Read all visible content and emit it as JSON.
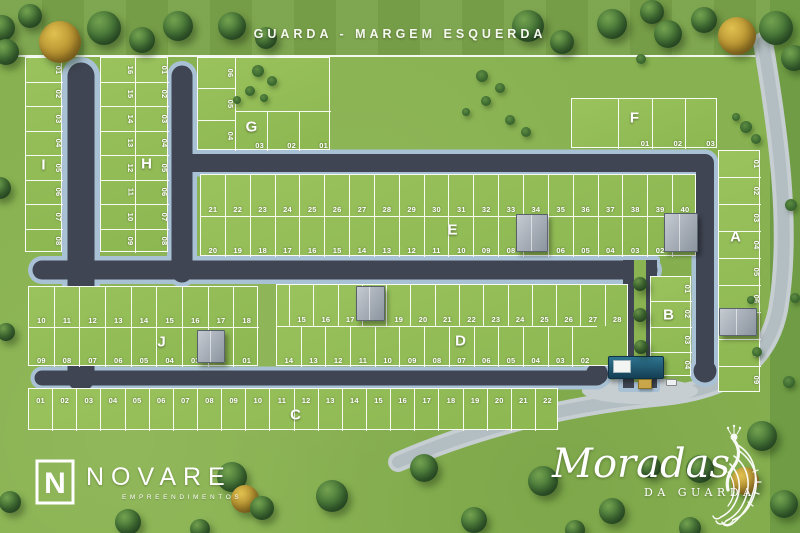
{
  "title": "GUARDA - MARGEM ESQUERDA",
  "branding": {
    "novare": {
      "icon_letter": "N",
      "name": "NOVARE",
      "subtitle": "EMPREENDIMENTOS"
    },
    "project": {
      "name": "Moradas",
      "subtitle": "DA GUARDA"
    }
  },
  "colors": {
    "grass": "#88b251",
    "block_grass": "#93bd58",
    "asphalt": "#3f4553",
    "sidewalk": "#a9c1d4",
    "exterior_road": "#c6ced1",
    "line_white": "#ffffff",
    "gate_roof": "#1d5570"
  },
  "blocks": [
    {
      "id": "A",
      "label": "A",
      "rows": [
        {
          "lots": [
            "01",
            "02",
            "03",
            "04",
            "05",
            "06",
            null,
            "08",
            "09"
          ]
        }
      ]
    },
    {
      "id": "B",
      "label": "B",
      "rows": [
        {
          "lots": [
            "01",
            "02",
            "03",
            "04"
          ]
        }
      ]
    },
    {
      "id": "C",
      "label": "C",
      "rows": [
        {
          "lots": [
            "01",
            "02",
            "03",
            "04",
            "05",
            "06",
            "07",
            "08",
            "09",
            "10",
            "11",
            "12",
            "13",
            "14",
            "15",
            "16",
            "17",
            "18",
            "19",
            "20",
            "21",
            "22"
          ]
        }
      ]
    },
    {
      "id": "D",
      "label": "D",
      "rows": [
        {
          "lots": [
            "15",
            "16",
            "17",
            null,
            "19",
            "20",
            "21",
            "22",
            "23",
            "24",
            "25",
            "26",
            "27",
            "28"
          ]
        },
        {
          "lots": [
            "14",
            "13",
            "12",
            "11",
            "10",
            "09",
            "08",
            "07",
            "06",
            "05",
            "04",
            "03",
            "02"
          ]
        }
      ]
    },
    {
      "id": "E",
      "label": "E",
      "rows": [
        {
          "lots": [
            "21",
            "22",
            "23",
            "24",
            "25",
            "26",
            "27",
            "28",
            "29",
            "30",
            "31",
            "32",
            "33",
            "34",
            "35",
            "36",
            "37",
            "38",
            "39",
            "40"
          ]
        },
        {
          "lots": [
            "20",
            "19",
            "18",
            "17",
            "16",
            "15",
            "14",
            "13",
            "12",
            "11",
            "10",
            "09",
            "08",
            null,
            "06",
            "05",
            "04",
            "03",
            "02",
            null
          ]
        }
      ]
    },
    {
      "id": "F",
      "label": "F",
      "rows": [
        {
          "lots": [
            null,
            "01",
            "02",
            "03"
          ]
        }
      ]
    },
    {
      "id": "G",
      "label": "G",
      "rows": [
        {
          "lots": [
            "06",
            "05",
            "04"
          ]
        },
        {
          "lots": [
            "03",
            "02",
            "01"
          ]
        }
      ]
    },
    {
      "id": "H",
      "label": "H",
      "rows": [
        {
          "lots": [
            "16",
            "15",
            "14",
            "13",
            "12",
            "11",
            "10",
            "09"
          ]
        },
        {
          "lots": [
            "01",
            "02",
            "03",
            "04",
            "05",
            "06",
            "07",
            "08"
          ]
        }
      ]
    },
    {
      "id": "I",
      "label": "I",
      "rows": [
        {
          "lots": [
            "01",
            "02",
            "03",
            "04",
            "05",
            "06",
            "07",
            "08"
          ]
        }
      ]
    },
    {
      "id": "J",
      "label": "J",
      "rows": [
        {
          "lots": [
            "10",
            "11",
            "12",
            "13",
            "14",
            "15",
            "16",
            "17",
            "18"
          ]
        },
        {
          "lots": [
            "09",
            "08",
            "07",
            "06",
            "05",
            "04",
            "03",
            "02",
            "01"
          ]
        }
      ]
    }
  ],
  "decor": {
    "trees": [
      [
        60,
        42,
        21,
        "y"
      ],
      [
        104,
        28,
        17
      ],
      [
        142,
        40,
        13
      ],
      [
        178,
        26,
        15
      ],
      [
        232,
        26,
        14
      ],
      [
        266,
        38,
        11
      ],
      [
        2,
        28,
        13
      ],
      [
        30,
        16,
        12
      ],
      [
        528,
        26,
        16
      ],
      [
        562,
        42,
        12
      ],
      [
        612,
        24,
        15
      ],
      [
        652,
        12,
        12
      ],
      [
        668,
        34,
        14
      ],
      [
        704,
        20,
        13
      ],
      [
        737,
        36,
        19,
        "y"
      ],
      [
        776,
        28,
        17
      ],
      [
        794,
        58,
        13
      ],
      [
        6,
        52,
        13
      ],
      [
        0,
        188,
        11
      ],
      [
        6,
        332,
        9
      ],
      [
        10,
        502,
        11
      ],
      [
        128,
        522,
        13
      ],
      [
        200,
        529,
        10
      ],
      [
        232,
        477,
        15
      ],
      [
        245,
        499,
        14,
        "y"
      ],
      [
        262,
        508,
        12
      ],
      [
        332,
        496,
        16
      ],
      [
        424,
        468,
        14
      ],
      [
        474,
        520,
        13
      ],
      [
        543,
        481,
        15
      ],
      [
        612,
        511,
        13
      ],
      [
        650,
        467,
        11
      ],
      [
        700,
        469,
        14
      ],
      [
        745,
        481,
        14,
        "y"
      ],
      [
        762,
        436,
        15
      ],
      [
        784,
        504,
        14
      ],
      [
        690,
        528,
        11
      ],
      [
        575,
        530,
        10
      ]
    ],
    "median_trees": [
      [
        640,
        284,
        7
      ],
      [
        640,
        315,
        7
      ],
      [
        641,
        347,
        7
      ]
    ],
    "bushes": [
      [
        258,
        71,
        6
      ],
      [
        272,
        81,
        5
      ],
      [
        250,
        91,
        5
      ],
      [
        264,
        98,
        4
      ],
      [
        237,
        100,
        4
      ],
      [
        482,
        76,
        6
      ],
      [
        500,
        88,
        5
      ],
      [
        486,
        101,
        5
      ],
      [
        466,
        112,
        4
      ],
      [
        510,
        120,
        5
      ],
      [
        526,
        132,
        5
      ],
      [
        746,
        127,
        6
      ],
      [
        756,
        139,
        5
      ],
      [
        736,
        117,
        4
      ],
      [
        641,
        59,
        5
      ],
      [
        791,
        205,
        6
      ],
      [
        795,
        298,
        5
      ],
      [
        789,
        382,
        6
      ],
      [
        757,
        352,
        5
      ],
      [
        751,
        300,
        4
      ]
    ],
    "houses": [
      [
        516,
        214,
        30,
        36
      ],
      [
        664,
        213,
        32,
        37
      ],
      [
        356,
        286,
        27,
        33
      ],
      [
        197,
        330,
        26,
        31
      ],
      [
        719,
        308,
        36,
        26
      ]
    ]
  }
}
